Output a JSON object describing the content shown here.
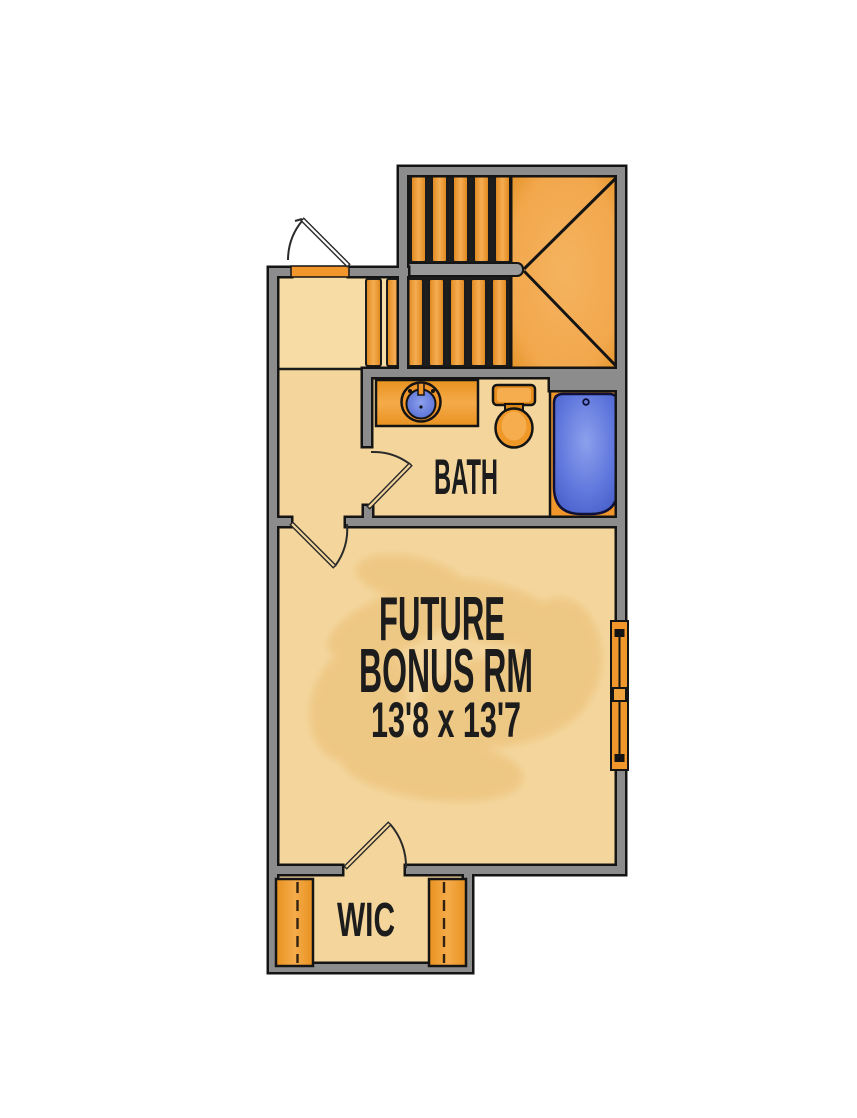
{
  "rooms": {
    "bonus": {
      "label_line1": "FUTURE",
      "label_line2": "BONUS RM",
      "dimensions": "13'8 x 13'7"
    },
    "bath": {
      "label": "BATH"
    },
    "wic": {
      "label": "WIC"
    }
  },
  "stairs": {
    "type": "u-shaped-with-winder-landing",
    "upper_flight_treads": 5,
    "lower_flight_treads": 7
  },
  "fixtures": [
    "vanity-sink",
    "toilet",
    "bathtub"
  ],
  "features": {
    "window_count": 1,
    "closet_rod_count": 2,
    "door_count": 4
  },
  "colors": {
    "accent_orange": "#f0962a",
    "orange_light": "#f5ab4a",
    "orange_dark": "#e08a1e",
    "floor_tan": "#f4d69d",
    "floor_tan_light": "#f7dca6",
    "floor_blotch": "#e9bc6f",
    "wall_gray": "#8c8c8c",
    "wall_outline": "#141414",
    "fixture_blue": "#5f77dd",
    "fixture_blue_light": "#8ca0ec",
    "fixture_blue_dark": "#3d54be",
    "text_color": "#1c1c1c",
    "background": "#ffffff"
  }
}
